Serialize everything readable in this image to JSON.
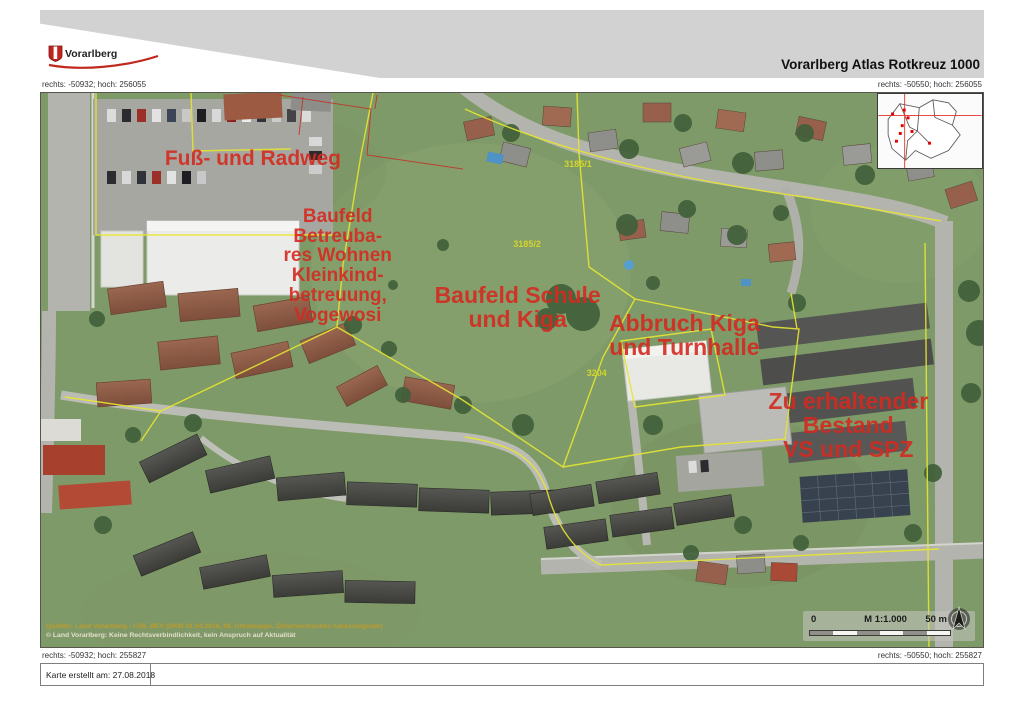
{
  "header": {
    "logo_text": "Vorarlberg",
    "title": "Vorarlberg Atlas Rotkreuz 1000"
  },
  "coords": {
    "top_left": "rechts: -50932; hoch: 256055",
    "top_right": "rechts: -50550; hoch: 256055",
    "bottom_left": "rechts: -50932; hoch: 255827",
    "bottom_right": "rechts: -50550; hoch: 255827"
  },
  "annotations": [
    {
      "id": "fuss-radweg",
      "lines": [
        "Fuß- und Radweg"
      ],
      "x": 22.5,
      "y": 12.0,
      "size": 21
    },
    {
      "id": "baufeld-wohnen",
      "lines": [
        "Baufeld",
        "Betreuba-",
        "res Wohnen",
        "Kleinkind-",
        "betreuung,",
        "Vogewosi"
      ],
      "x": 31.5,
      "y": 31.2,
      "size": 19
    },
    {
      "id": "baufeld-schule",
      "lines": [
        "Baufeld Schule",
        "und Kiga"
      ],
      "x": 50.6,
      "y": 38.8,
      "size": 23
    },
    {
      "id": "abbruch-kiga",
      "lines": [
        "Abbruch Kiga",
        "und Turnhalle"
      ],
      "x": 68.3,
      "y": 43.9,
      "size": 23
    },
    {
      "id": "bestand-vs-spz",
      "lines": [
        "Zu erhaltender",
        "Bestand",
        "VS und SPZ"
      ],
      "x": 85.7,
      "y": 60.1,
      "size": 23
    }
  ],
  "parcel_labels": [
    {
      "label": "3185/1",
      "x": 57.0,
      "y": 12.8
    },
    {
      "label": "3185/2",
      "x": 51.6,
      "y": 27.3
    },
    {
      "label": "3204",
      "x": 59.0,
      "y": 50.5
    }
  ],
  "scalebar": {
    "zero": "0",
    "ratio": "M 1:1.000",
    "distance": "50 m"
  },
  "sources": {
    "line1": "Quellen: Land Vorarlberg - LVB, BEV (DKM 01.04.2018, 08, Ultramappe, Österreichisches Adressregister)",
    "line2": "© Land Vorarlberg: Keine Rechtsverbindlichkeit, kein Anspruch auf Aktualität"
  },
  "footer": {
    "created": "Karte erstellt am: 27.08.2018"
  },
  "colors": {
    "annotation_red": "#d42a20",
    "parcel_yellow": "#e6e632",
    "header_gray": "#d2d2d2",
    "meadow_green": "#7e9a68"
  }
}
